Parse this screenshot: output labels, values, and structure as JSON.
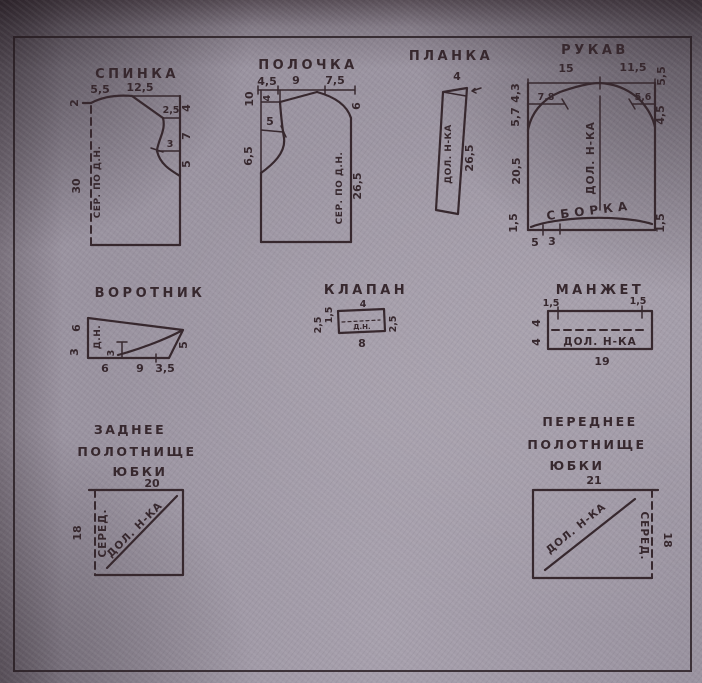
{
  "colors": {
    "paper": "#9a93a0",
    "ink": "#37282e"
  },
  "pieces": {
    "spinka": {
      "title": "СПИНКА",
      "m_shoulder_a": "5,5",
      "m_shoulder_b": "12,5",
      "m_neck": "2",
      "m_in_a": "2,5",
      "m_in_b": "3",
      "m_side_a": "4",
      "m_side_b": "7",
      "m_side_c": "5",
      "m_length": "30",
      "center_line": "СЕР. ПО Д.Н."
    },
    "polochka": {
      "title": "ПОЛОЧКА",
      "m_top_a": "4,5",
      "m_top_b": "9",
      "m_top_c": "7,5",
      "m_left_a": "10",
      "m_in_a": "4",
      "m_in_b": "5",
      "m_left_b": "6,5",
      "m_neck": "6",
      "m_length": "26,5",
      "center_line": "СЕР. ПО Д.Н."
    },
    "planka": {
      "title": "ПЛАНКА",
      "m_width": "4",
      "m_length": "26,5",
      "grain_line": "ДОЛ. Н-КА"
    },
    "rukav": {
      "title": "РУКАВ",
      "m_top_a": "15",
      "m_top_b": "11,5",
      "m_left_a": "4,3",
      "m_left_b": "5,7",
      "m_left_c": "20,5",
      "m_left_d": "1,5",
      "m_cap_a": "7,8",
      "m_cap_b": "5,6",
      "m_right_a": "5,5",
      "m_right_b": "4,5",
      "m_right_c": "1,5",
      "m_bottom_a": "5",
      "m_bottom_b": "3",
      "gather_label": "СБОРКА",
      "grain_line": "ДОЛ. Н-КА"
    },
    "vorotnik": {
      "title": "ВОРОТНИК",
      "m_left_a": "6",
      "m_left_b": "3",
      "m_in": "3",
      "grain_line": "Д.Н.",
      "m_right": "5",
      "m_bottom_a": "6",
      "m_bottom_b": "9",
      "m_bottom_c": "3,5"
    },
    "klapan": {
      "title": "КЛАПАН",
      "m_top": "4",
      "m_left_a": "1,5",
      "m_left_b": "2,5",
      "m_right": "2,5",
      "m_bottom": "8",
      "grain_line": "Д.Н."
    },
    "manzhet": {
      "title": "МАНЖЕТ",
      "m_top_a": "1,5",
      "m_top_b": "1,5",
      "m_left_a": "4",
      "m_left_b": "4",
      "grain_line": "ДОЛ. Н-КА",
      "m_bottom": "19"
    },
    "zadnee_polotnishche": {
      "title_line1": "ЗАДНЕЕ",
      "title_line2": "ПОЛОТНИЩЕ",
      "title_line3": "ЮБКИ",
      "m_top": "20",
      "m_left": "18",
      "center_line": "СЕРЕД.",
      "grain_line": "ДОЛ. Н-КА"
    },
    "perednee_polotnishche": {
      "title_line1": "ПЕРЕДНЕЕ",
      "title_line2": "ПОЛОТНИЩЕ",
      "title_line3": "ЮБКИ",
      "m_top": "21",
      "m_right": "18",
      "center_line": "СЕРЕД.",
      "grain_line": "ДОЛ. Н-КА"
    }
  }
}
